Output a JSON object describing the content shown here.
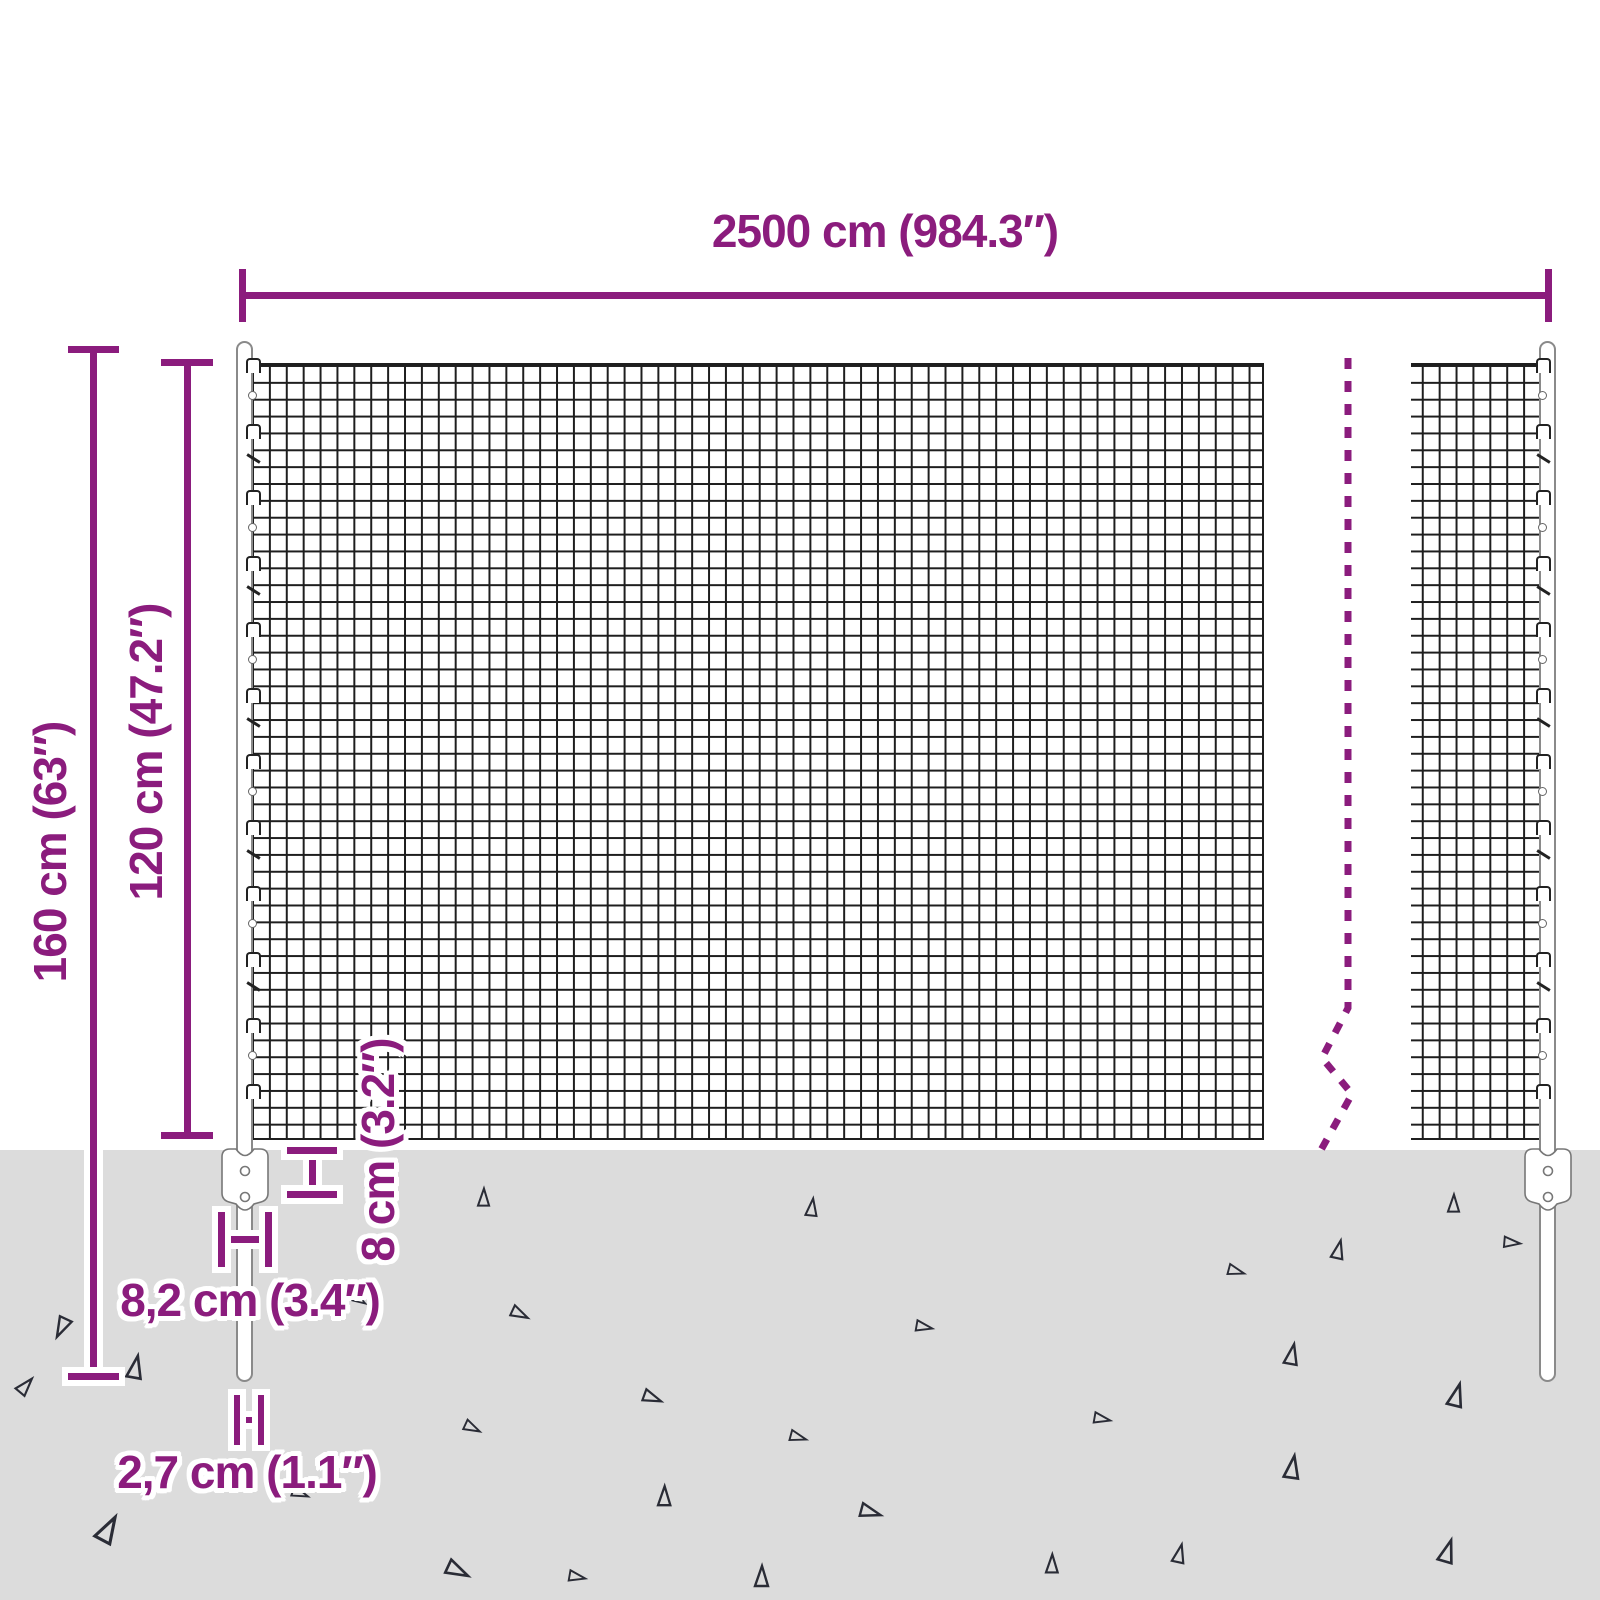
{
  "diagram": {
    "type": "product-dimension-diagram",
    "subject": "wire mesh fence with posts and ground anchors",
    "labels": {
      "total_width": "2500 cm (984.3″)",
      "total_height": "160 cm (63″)",
      "mesh_height": "120 cm (47.2″)",
      "anchor_depth": "8 cm (3.2″)",
      "anchor_width": "8,2 cm (3.4″)",
      "post_diameter": "2,7 cm (1.1″)"
    },
    "colors": {
      "accent": "#8B1C7D",
      "ground": "#DCDCDC",
      "mesh_line": "#1E1E1E"
    }
  }
}
